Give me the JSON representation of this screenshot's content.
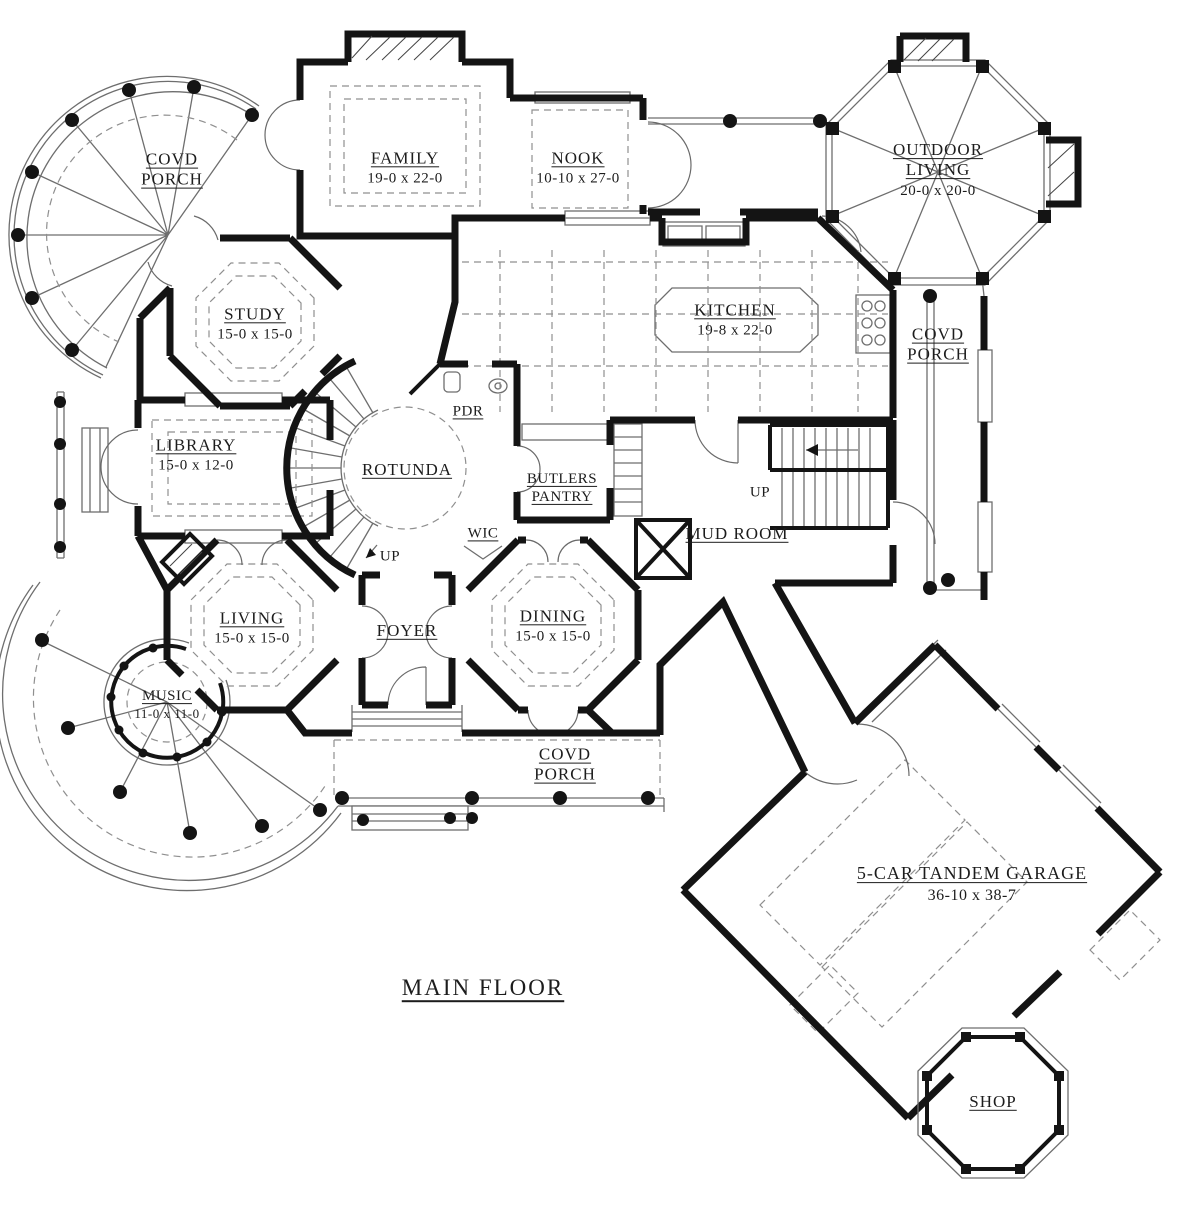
{
  "title": "MAIN FLOOR",
  "colors": {
    "wall": "#141414",
    "thin": "#6e6e6e",
    "dash": "#8f8f8f",
    "text": "#1c1c1c",
    "bg": "#ffffff"
  },
  "rooms": {
    "covd_porch_nw": {
      "name": "COVD PORCH",
      "dims": ""
    },
    "family": {
      "name": "FAMILY",
      "dims": "19-0 x 22-0"
    },
    "nook": {
      "name": "NOOK",
      "dims": "10-10 x 27-0"
    },
    "outdoor_living": {
      "name": "OUTDOOR LIVING",
      "dims": "20-0 x 20-0"
    },
    "study": {
      "name": "STUDY",
      "dims": "15-0 x 15-0"
    },
    "kitchen": {
      "name": "KITCHEN",
      "dims": "19-8 x 22-0"
    },
    "covd_porch_e": {
      "name": "COVD PORCH",
      "dims": ""
    },
    "library": {
      "name": "LIBRARY",
      "dims": "15-0 x 12-0"
    },
    "rotunda": {
      "name": "ROTUNDA",
      "dims": ""
    },
    "pdr": {
      "name": "PDR",
      "dims": ""
    },
    "butlers_pantry": {
      "name": "BUTLERS PANTRY",
      "dims": ""
    },
    "wic": {
      "name": "WIC",
      "dims": ""
    },
    "mud_room": {
      "name": "MUD ROOM",
      "dims": ""
    },
    "up_main_stairs": {
      "name": "UP",
      "dims": ""
    },
    "up_rotunda": {
      "name": "UP",
      "dims": ""
    },
    "living": {
      "name": "LIVING",
      "dims": "15-0 x 15-0"
    },
    "foyer": {
      "name": "FOYER",
      "dims": ""
    },
    "dining": {
      "name": "DINING",
      "dims": "15-0 x 15-0"
    },
    "music": {
      "name": "MUSIC",
      "dims": "11-0 x 11-0"
    },
    "covd_porch_s": {
      "name": "COVD PORCH",
      "dims": ""
    },
    "garage": {
      "name": "5-CAR TANDEM GARAGE",
      "dims": "36-10 x 38-7"
    },
    "shop": {
      "name": "SHOP",
      "dims": ""
    }
  }
}
